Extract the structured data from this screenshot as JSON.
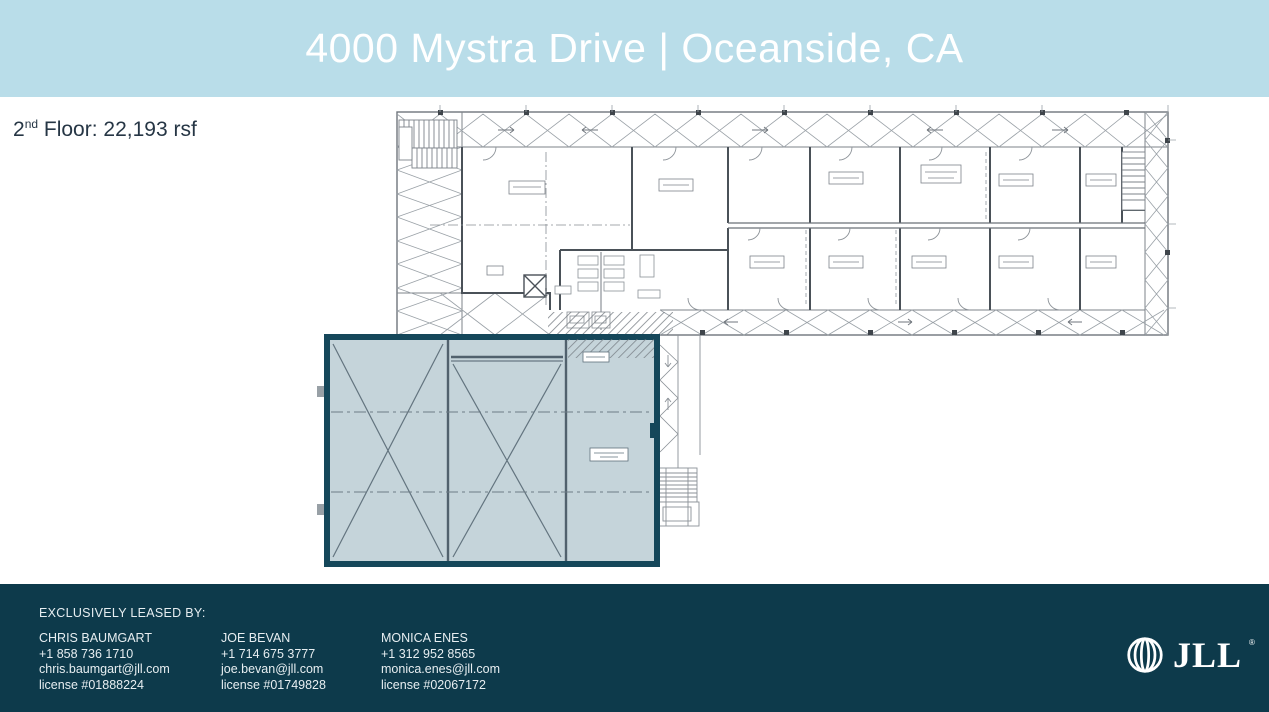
{
  "header": {
    "title": "4000 Mystra Drive | Oceanside, CA",
    "bg_color": "#b9dde9",
    "text_color": "#ffffff"
  },
  "floor_info": {
    "number": "2",
    "ordinal": "nd",
    "label": " Floor: 22,193 rsf"
  },
  "floor_plan": {
    "highlight_fill": "#c3d2d9",
    "highlight_border": "#15475a",
    "drawing_line_color": "#8b9197"
  },
  "footer": {
    "bg_color": "#0d3a4b",
    "heading": "EXCLUSIVELY LEASED BY:",
    "contacts": [
      {
        "name": "CHRIS BAUMGART",
        "phone": "+1 858 736 1710",
        "email": "chris.baumgart@jll.com",
        "license": "license #01888224"
      },
      {
        "name": "JOE BEVAN",
        "phone": "+1 714 675 3777",
        "email": "joe.bevan@jll.com",
        "license": "license #01749828"
      },
      {
        "name": "MONICA ENES",
        "phone": "+1 312 952 8565",
        "email": "monica.enes@jll.com",
        "license": "license #02067172"
      }
    ],
    "logo_text": "JLL",
    "logo_reg": "®"
  }
}
